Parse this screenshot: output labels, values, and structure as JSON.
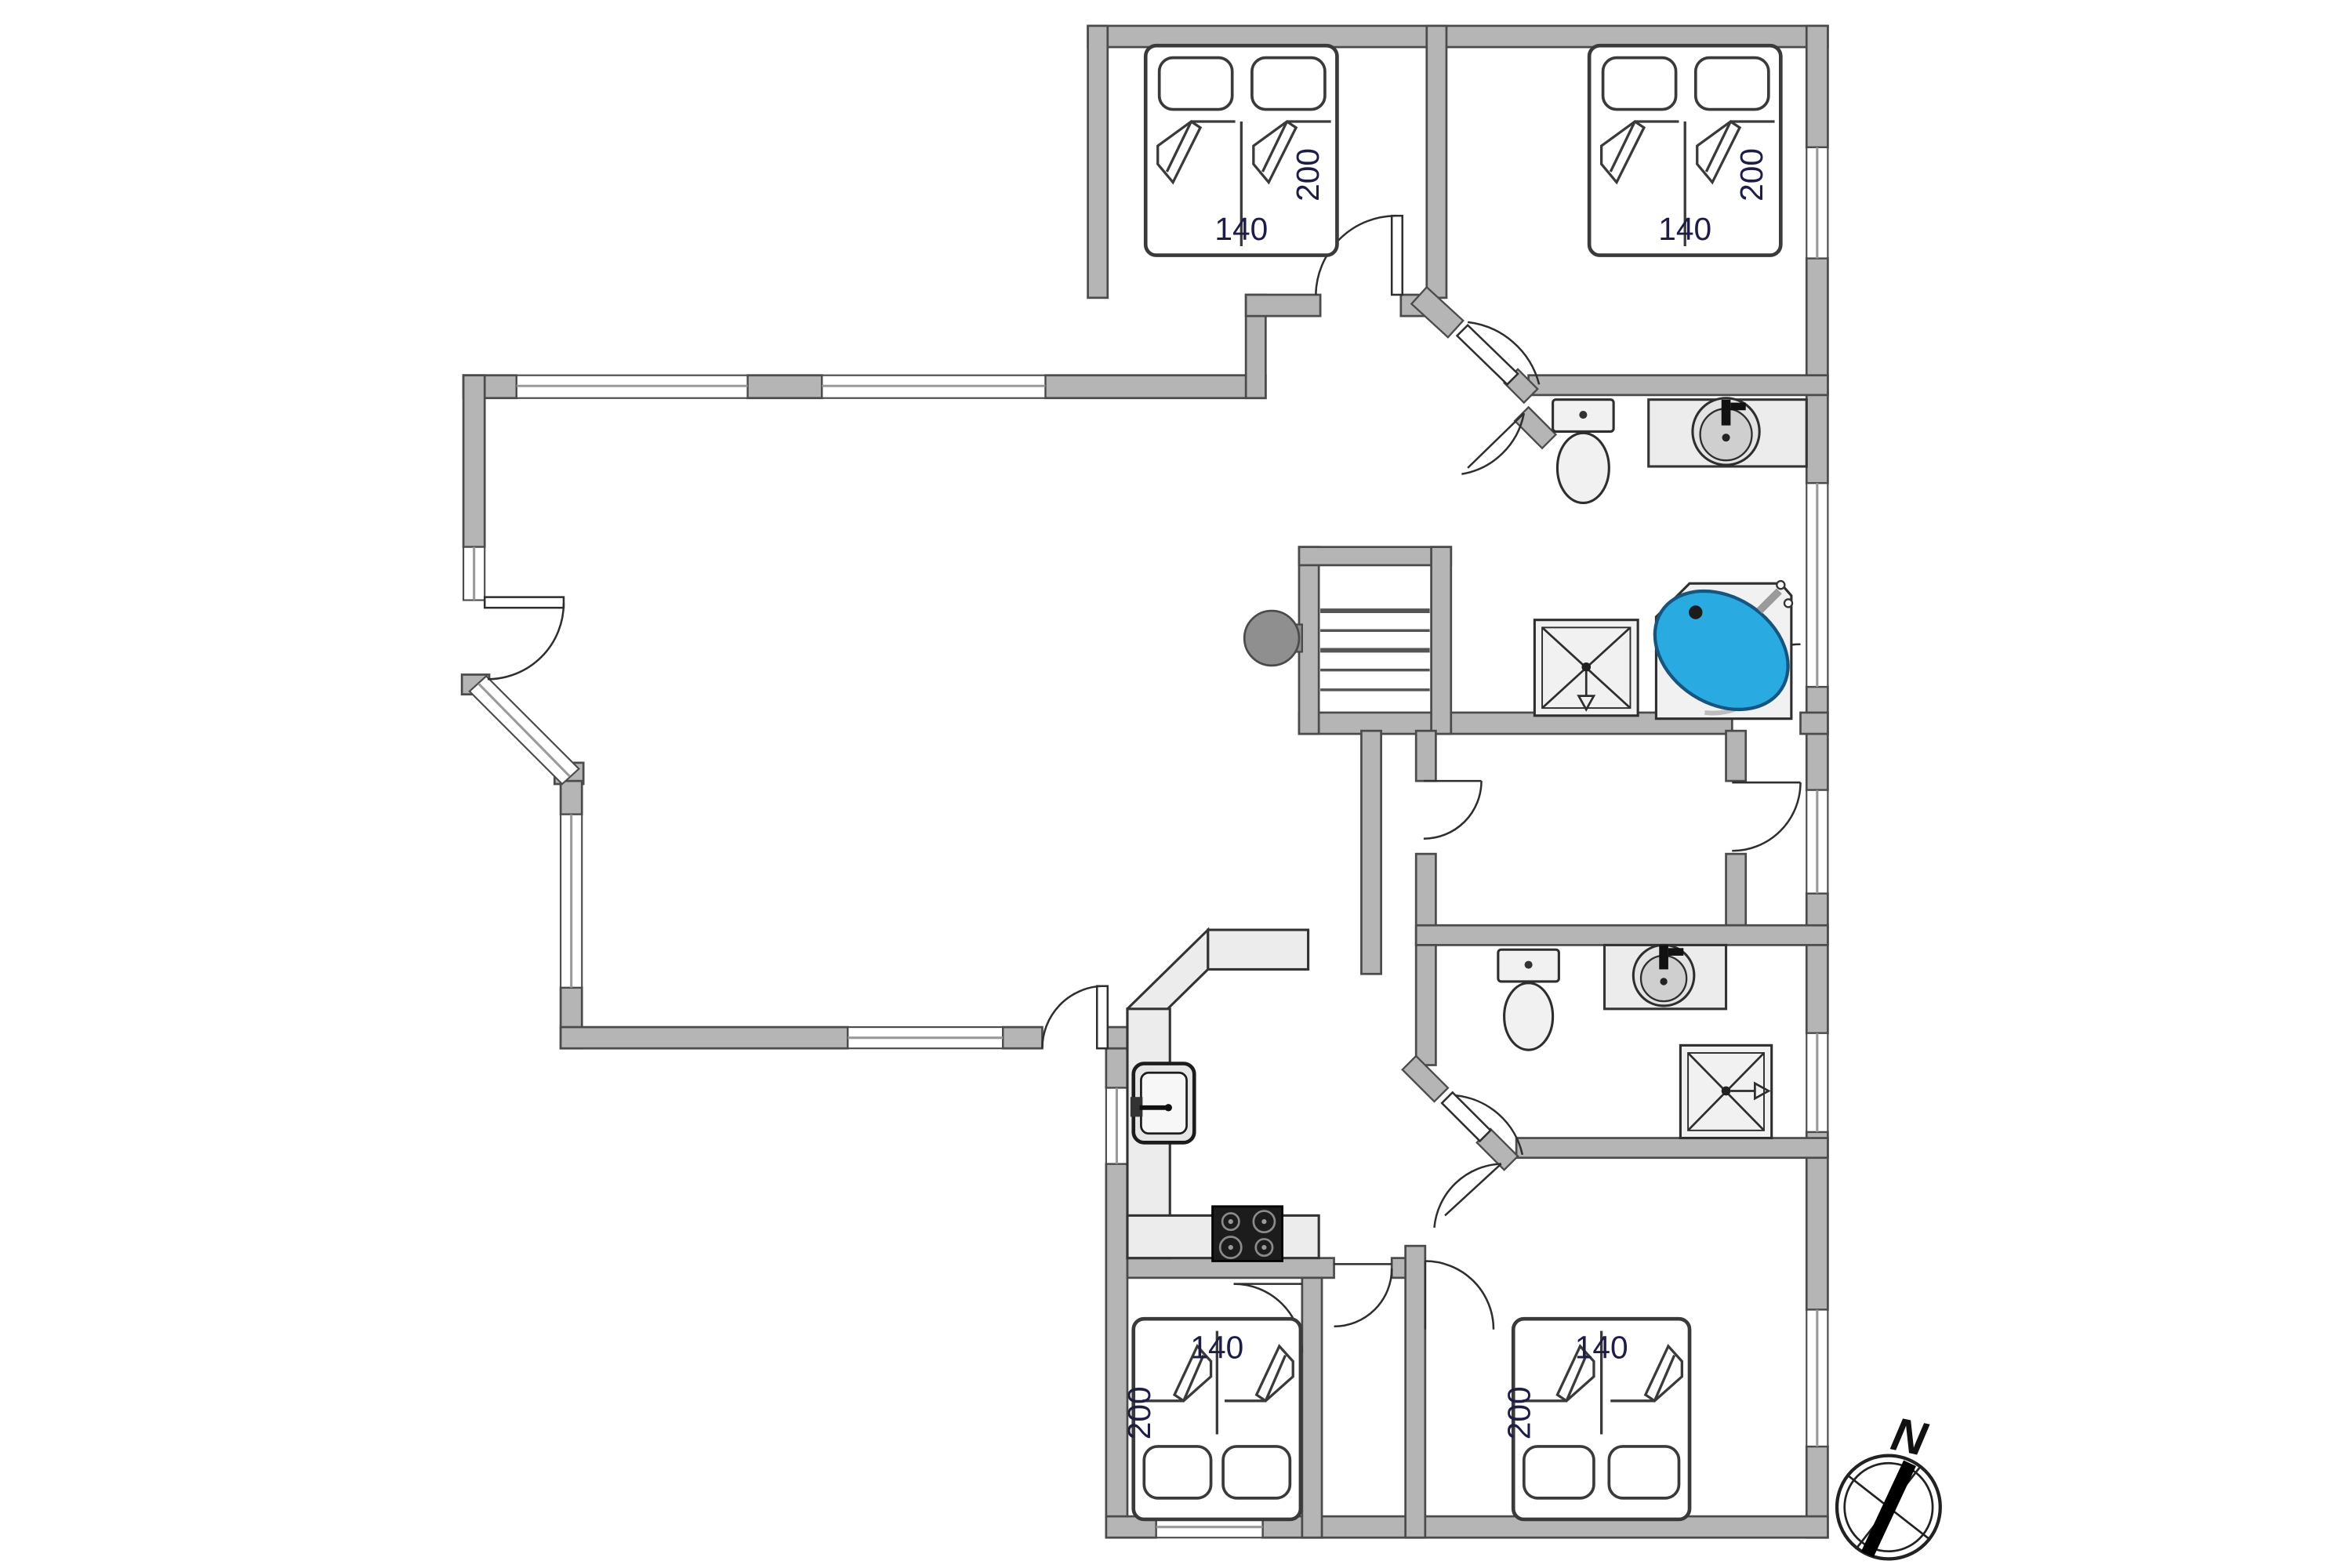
{
  "plan": {
    "type": "holiday-house floor plan, top-down architectural drawing",
    "compass": {
      "north_label": "N"
    },
    "bedrooms": {
      "top_left": {
        "bed_width_cm": "140",
        "bed_length_cm": "200"
      },
      "top_right": {
        "bed_width_cm": "140",
        "bed_length_cm": "200"
      },
      "bottom_left": {
        "bed_width_cm": "140",
        "bed_length_cm": "200"
      },
      "bottom_right": {
        "bed_width_cm": "140",
        "bed_length_cm": "200"
      }
    },
    "fixtures": [
      "toilet-upper-bathroom",
      "round-sink-upper-bathroom",
      "shower-upper-bathroom",
      "corner-bathtub-blue",
      "staircase",
      "wood-stove",
      "kitchen-counter-L",
      "kitchen-sink",
      "cooktop-4-burners",
      "toilet-lower-bathroom",
      "round-sink-lower-bathroom",
      "shower-lower-bathroom"
    ],
    "colors": {
      "wall": "#b5b5b5",
      "wall_outline": "#4b4b4b",
      "bathtub_water": "#29abe2",
      "fixture_fill": "#f1f1f1",
      "counter_fill": "#ececec",
      "cooktop": "#1c1c1c",
      "label_text": "#1d1d46"
    }
  }
}
